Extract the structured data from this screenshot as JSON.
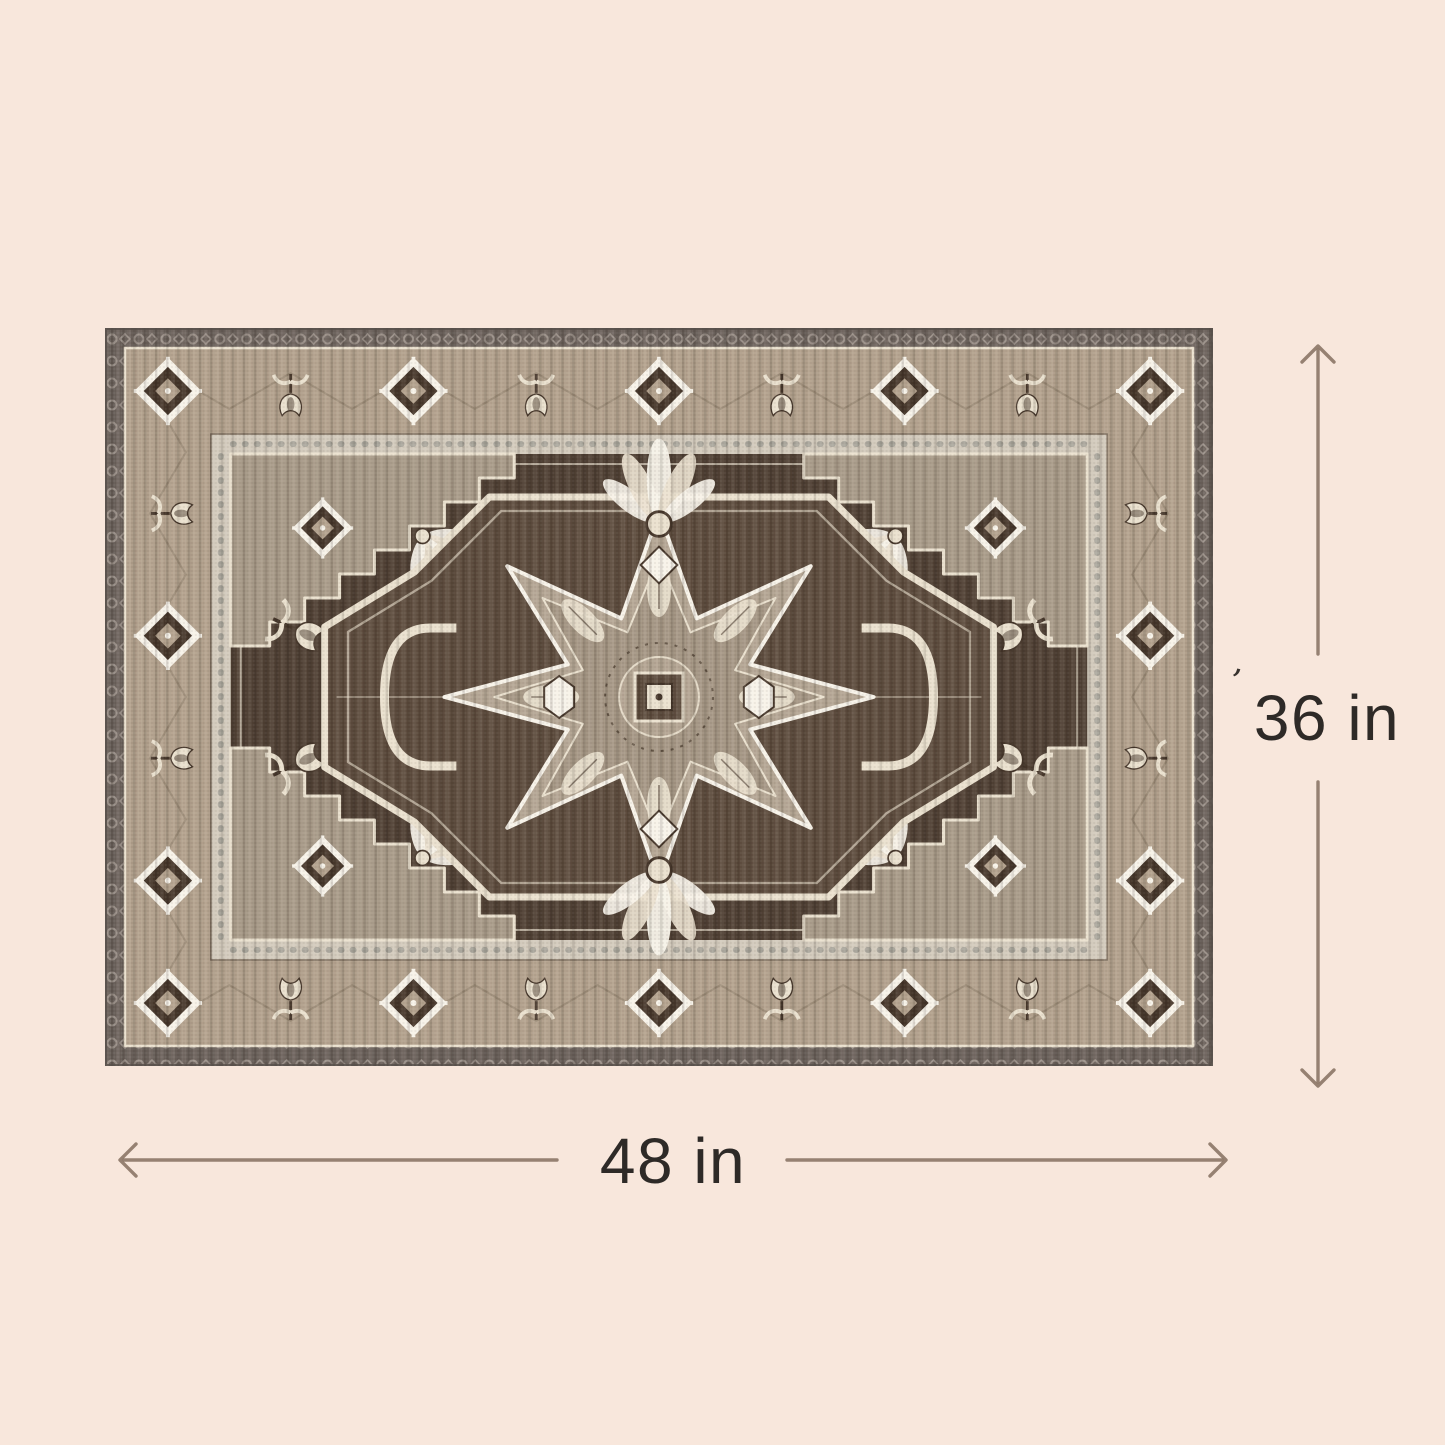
{
  "dimensions": {
    "height_label": "36 in",
    "width_label": "48 in",
    "stray_mark": "’"
  },
  "colors": {
    "background": "#f8e7dc",
    "annotation": "#8b7566",
    "text": "#2e2a27",
    "stray": "#38322d",
    "rug": {
      "outer": "#6a615b",
      "outerMotif": "#998f88",
      "edge": "#554e49",
      "border": "#b1a08c",
      "cream": "#eae1cf",
      "white": "#f7f3ea",
      "dark": "#46372b",
      "vine": "#8b7b67",
      "guard": "#d2cabc",
      "guardLine": "#7b6c5c",
      "steel": "#82837e",
      "field": "#4f4034",
      "fieldLight": "#5d4c3e",
      "spandrel": "#a79a88",
      "star": "#b3a593",
      "starIn": "#a49684"
    }
  }
}
